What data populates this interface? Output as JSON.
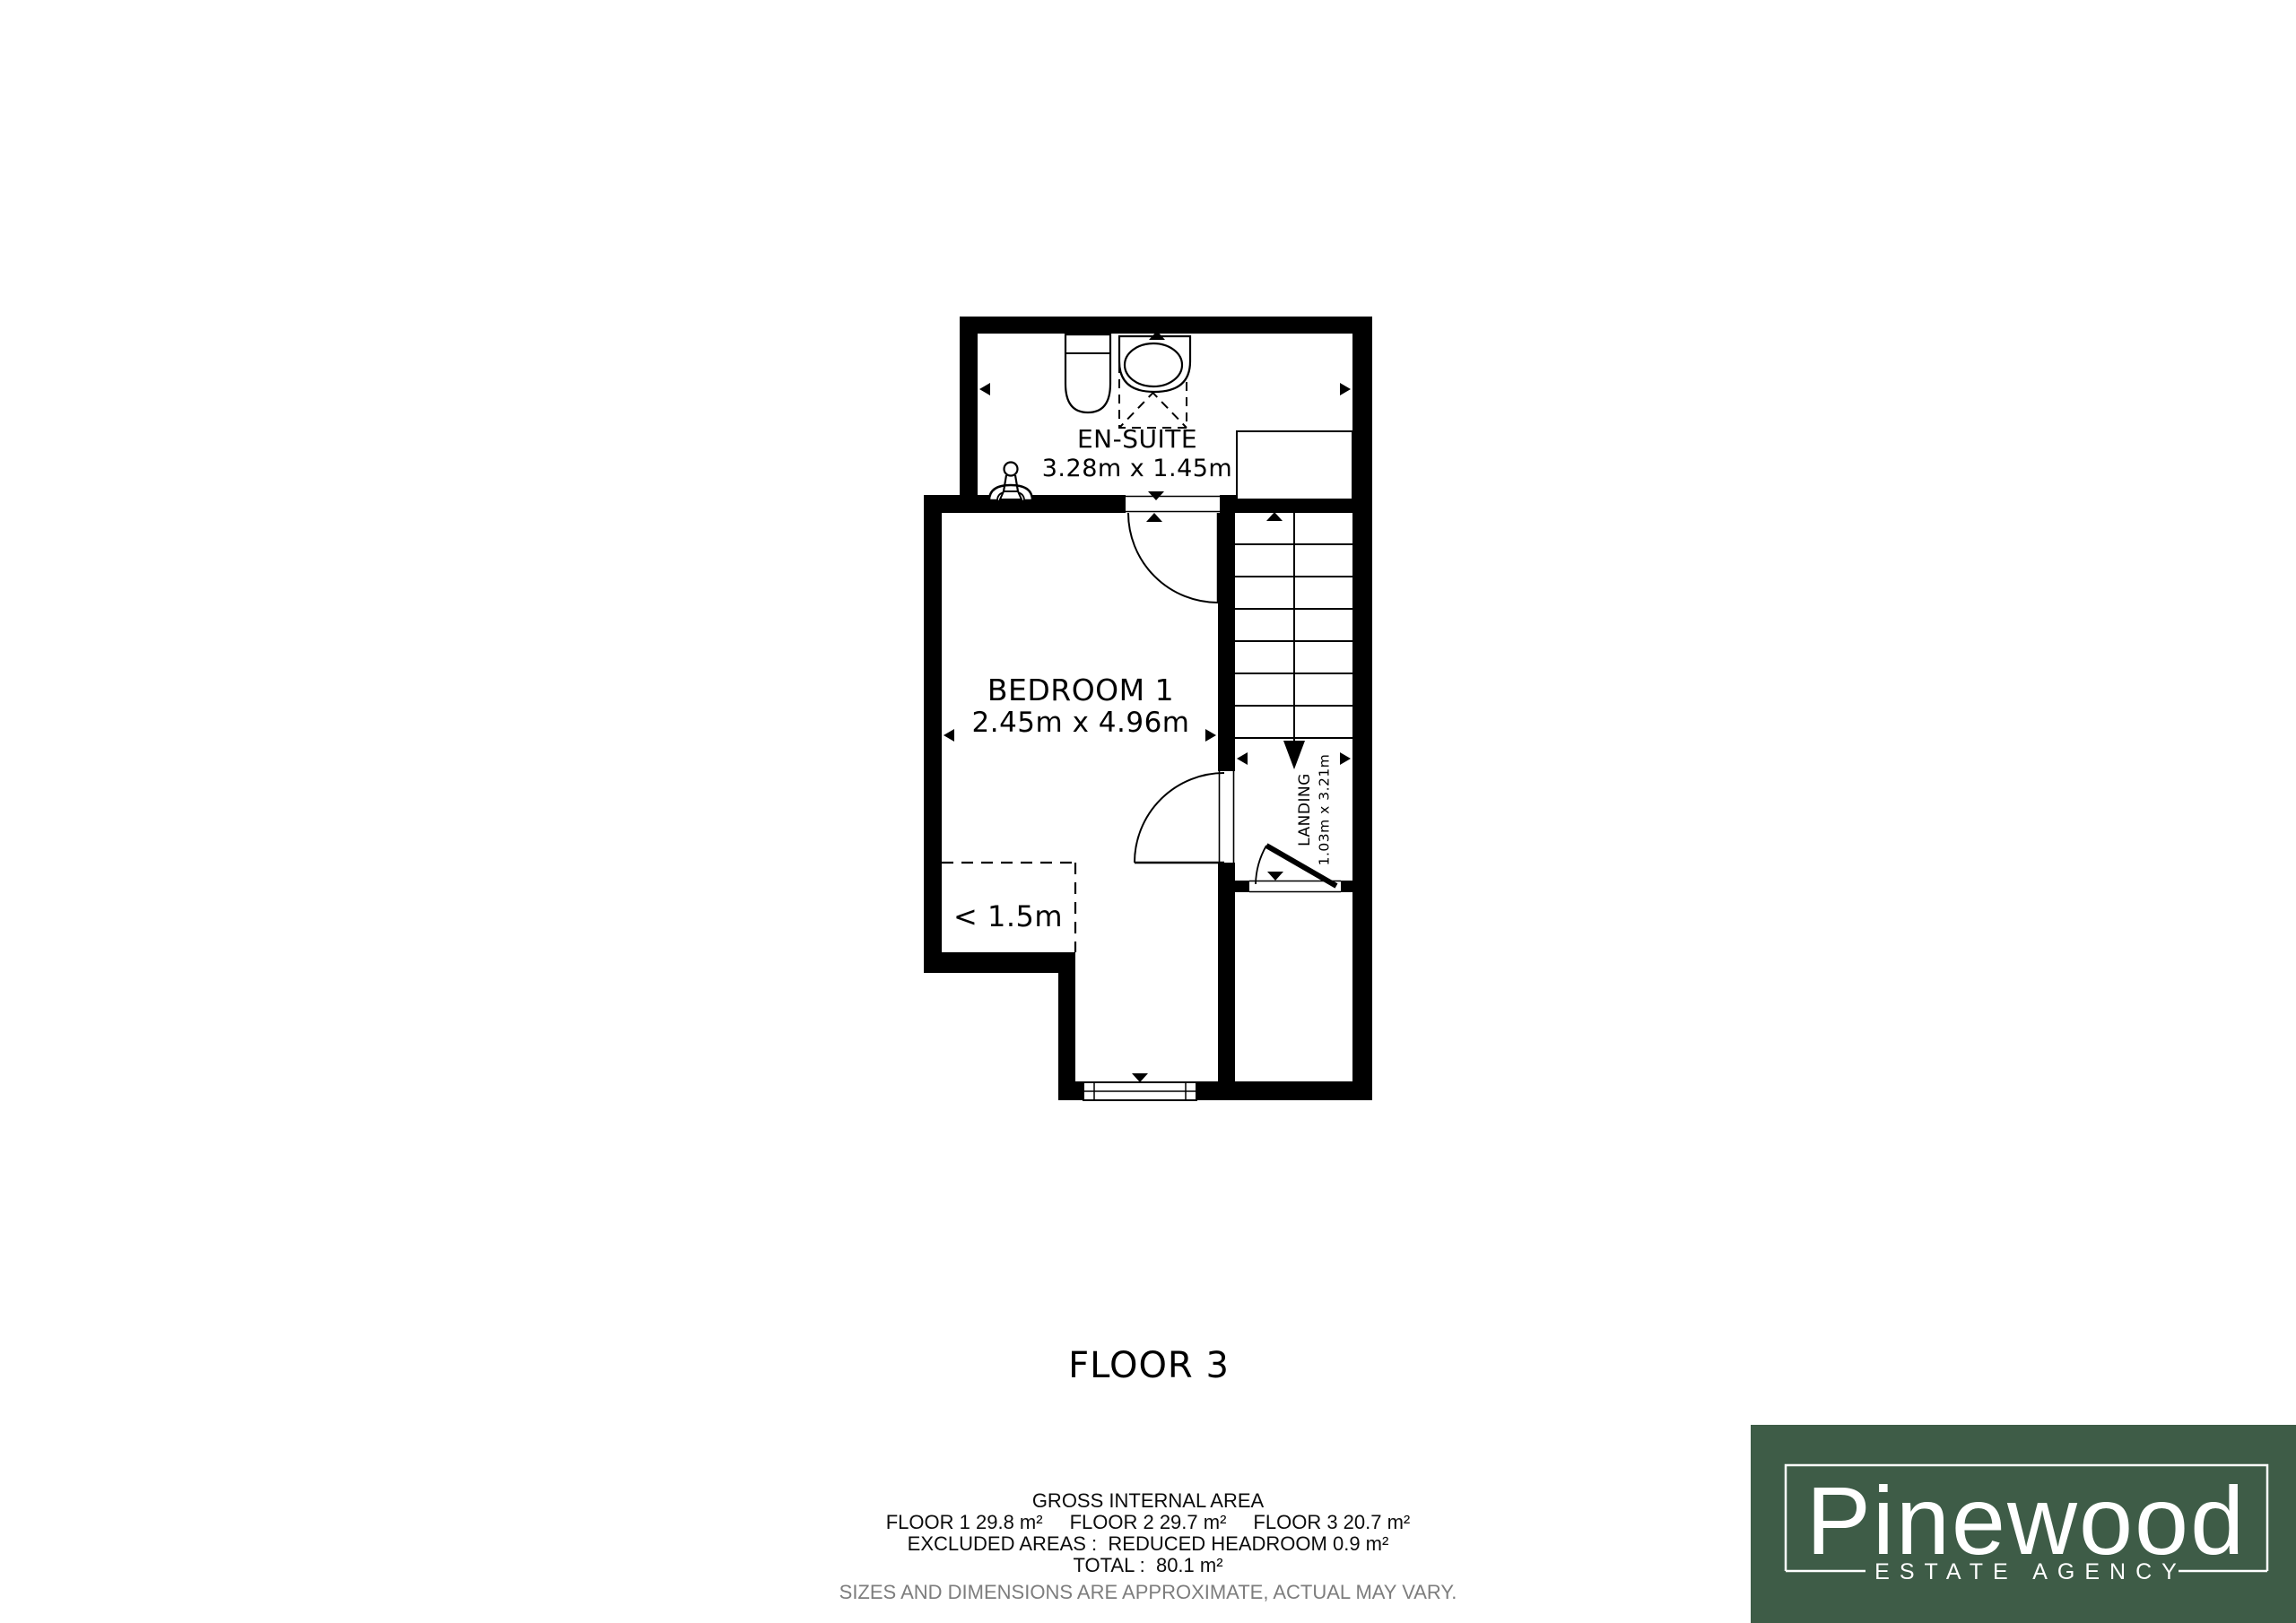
{
  "floor_title": "FLOOR 3",
  "floor_plan": {
    "rooms": {
      "ensuite": {
        "name": "EN-SUITE",
        "dimensions": "3.28m x 1.45m"
      },
      "bedroom": {
        "name": "BEDROOM 1",
        "dimensions": "2.45m x 4.96m"
      },
      "landing": {
        "name": "LANDING",
        "dimensions": "1.03m x 3.21m"
      },
      "reduced_headroom_label": "< 1.5m"
    }
  },
  "area_summary": {
    "heading": "GROSS INTERNAL AREA",
    "floor_areas": [
      "FLOOR 1 29.8 m²",
      "FLOOR 2 29.7 m²",
      "FLOOR 3 20.7 m²"
    ],
    "excluded": "EXCLUDED AREAS :  REDUCED HEADROOM 0.9 m²",
    "total": "TOTAL :  80.1 m²",
    "disclaimer": "SIZES AND DIMENSIONS ARE APPROXIMATE, ACTUAL MAY VARY."
  },
  "logo": {
    "brand": "Pinewood",
    "tagline": "ESTATE AGENCY",
    "background_color": "#3e5c47",
    "text_color": "#ffffff"
  },
  "colors": {
    "wall": "#000000",
    "plan_background": "#ffffff",
    "disclaimer_gray": "#7d7d7d"
  }
}
